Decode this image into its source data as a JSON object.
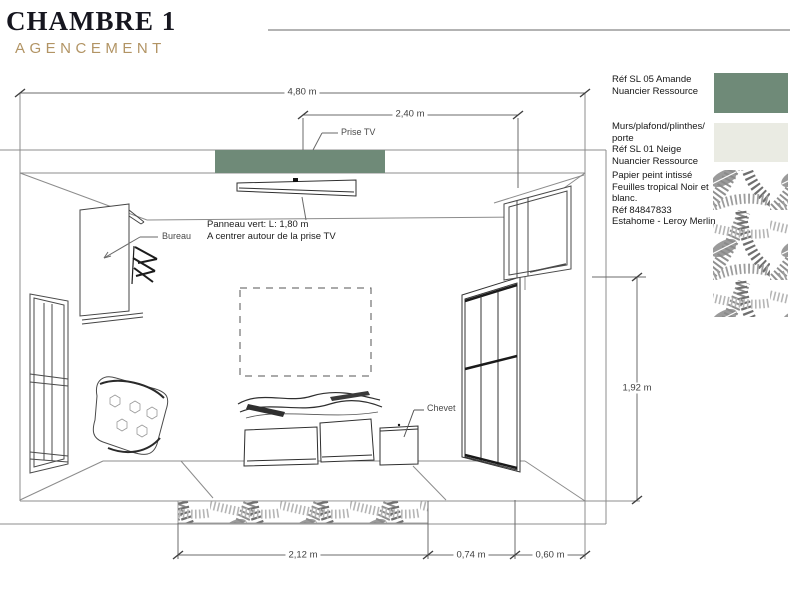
{
  "title": {
    "main": "CHAMBRE 1",
    "subtitle": "AGENCEMENT"
  },
  "annotations": {
    "prise_tv": "Prise TV",
    "bureau": "Bureau",
    "chevet": "Chevet",
    "panneau": "Panneau vert: L: 1,80 m\nA centrer autour de la prise TV"
  },
  "dimensions": {
    "wall_total_width": "4,80 m",
    "tv_to_wall": "2,40 m",
    "right_height": "1,92 m",
    "rug_width": "2,12 m",
    "gap_width": "0,74 m",
    "wardrobe_width": "0,60 m"
  },
  "legend": {
    "items": [
      {
        "text": "Réf  SL 05 Amande\nNuancier Ressource",
        "color": "#6f8a78",
        "swatch": "amande"
      },
      {
        "text": "Murs/plafond/plinthes/\nporte\nRéf  SL 01 Neige\nNuancier Ressource",
        "color": "#eaebe3",
        "swatch": "neige"
      },
      {
        "text": "Papier peint intissé\nFeuilles tropical Noir et\nblanc.\nRéf 84847833\nEstahome - Leroy Merlin",
        "swatch": "tropical-wallpaper"
      }
    ]
  },
  "colors": {
    "amande_green": "#6f8a78",
    "neige_white": "#eaebe3",
    "subtitle_tan": "#b29464",
    "line_gray": "#8c8c8c"
  }
}
